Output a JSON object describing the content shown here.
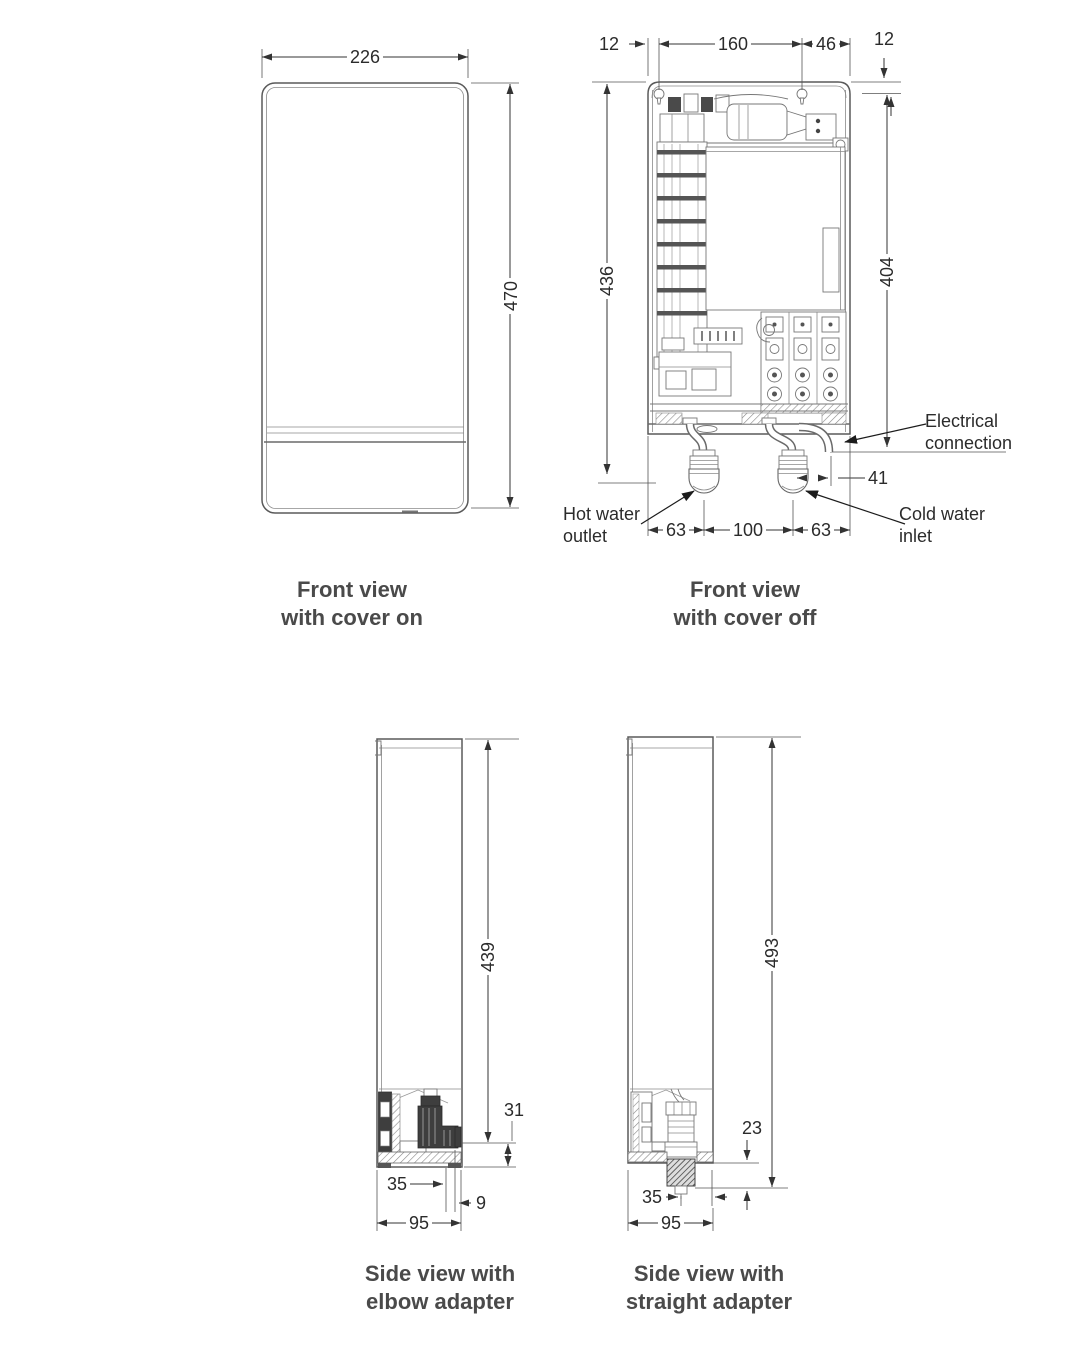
{
  "page": {
    "background": "#ffffff",
    "line_color": "#5a5a5a",
    "dim_color": "#2b2b2b"
  },
  "views": {
    "front_cover_on": {
      "caption": {
        "line1": "Front view",
        "line2": "with cover on"
      },
      "dims": {
        "width_mm": "226",
        "height_mm": "470"
      }
    },
    "front_cover_off": {
      "caption": {
        "line1": "Front view",
        "line2": "with cover off"
      },
      "dims": {
        "edge_to_hole": "12",
        "hole_spacing": "160",
        "hole_to_edge": "46",
        "top_to_hole": "12",
        "overall_left": "436",
        "overall_right": "404",
        "inlet_to_conduit": "41",
        "edge_to_outlet": "63",
        "outlet_to_inlet": "100",
        "inlet_to_edge": "63"
      },
      "labels": {
        "electrical_line1": "Electrical",
        "electrical_line2": "connection",
        "hot_line1": "Hot water",
        "hot_line2": "outlet",
        "cold_line1": "Cold water",
        "cold_line2": "inlet"
      }
    },
    "side_elbow": {
      "caption": {
        "line1": "Side view with",
        "line2": "elbow adapter"
      },
      "dims": {
        "height": "439",
        "outlet_drop": "31",
        "outlet_depth": "35",
        "protrusion": "9",
        "depth": "95"
      }
    },
    "side_straight": {
      "caption": {
        "line1": "Side view with",
        "line2": "straight adapter"
      },
      "dims": {
        "height": "493",
        "adapter_drop": "23",
        "adapter_depth": "35",
        "depth": "95"
      }
    }
  }
}
